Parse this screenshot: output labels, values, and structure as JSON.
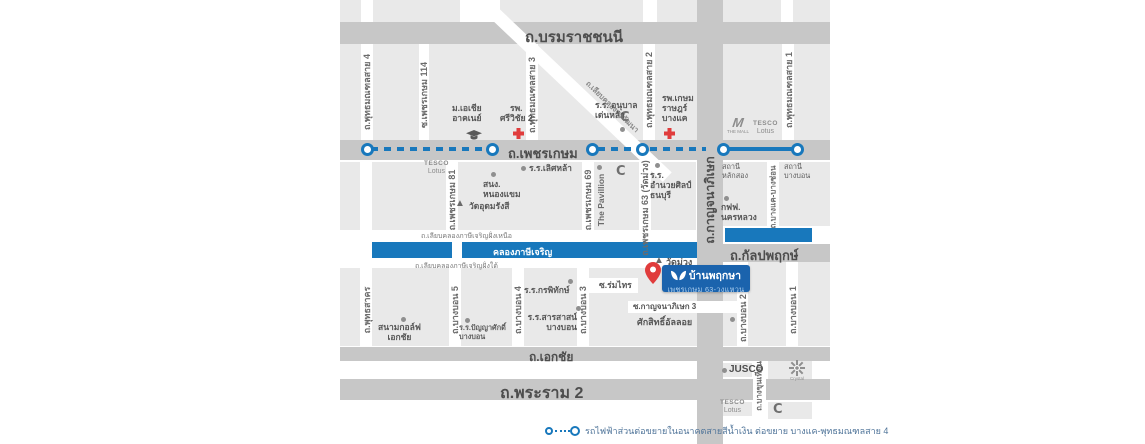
{
  "colors": {
    "canal_blue": "#1878bc",
    "mrt_blue": "#1878bc",
    "badge_blue": "#1b63ad",
    "marker_red": "#e03c3c",
    "block_gray": "#e9e9e9",
    "road_gray": "#c7c7c7"
  },
  "roads": {
    "borommaratchachonnani": "ถ.บรมราชชนนี",
    "phetkasem": "ถ.เพชรเกษม",
    "kanchanaphisek": "ถ.กาญจนาภิเษก",
    "kanlapaphruek": "ถ.กัลปพฤกษ์",
    "ekkachai": "ถ.เอกชัย",
    "rama2": "ถ.พระราม 2",
    "phutthamonthon4": "ถ.พุทธมณฑลสาย 4",
    "phetkasem114": "ซ.เพชรเกษม 114",
    "phutthamonthon3": "ถ.พุทธมณฑลสาย 3",
    "phutthamonthon2": "ถ.พุทธมณฑลสาย 2",
    "phutthamonthon1": "ถ.พุทธมณฑลสาย 1",
    "phetkasem81": "ถ.เพชรเกษม 81",
    "phetkasem69": "ถ.เพชรเกษม 69",
    "phetkasem63": "ถ.เพชรเกษม 63 (วัดม่วง)",
    "bangkhae_bangchon": "ถ.บางแค-บางช่อน",
    "phutthasakhon": "ถ.พุทธสาคร",
    "bangbon5": "ถ.บางบอน 5",
    "bangbon4": "ถ.บางบอน 4",
    "bangbon3": "ถ.บางบอน 3",
    "bangbon2": "ถ.บางบอน 2",
    "bangbon1": "ถ.บางบอน 1",
    "bangkhuntian": "ถ.บางขุนเทียน",
    "liapkhlong_thawiwatthana": "ถ.เลียบคลองทวีวัฒนา",
    "soi_romsai": "ซ.ร่มไทร",
    "soi_kanchanaphisek3": "ซ.กาญจนาภิเษก 3"
  },
  "canal": {
    "name": "คลองภาษีเจริญ",
    "north_bank_road": "ถ.เลียบคลองภาษีเจริญฝั่งเหนือ",
    "south_bank_road": "ถ.เลียบคลองภาษีเจริญฝั่งใต้"
  },
  "pois": {
    "asia_university": {
      "lines": [
        "ม.เอเชีย",
        "อาคเนย์"
      ]
    },
    "srivichai2_hospital": {
      "lines": [
        "รพ.",
        "ศรีวิชัย 2"
      ]
    },
    "denla_kindergarten": {
      "lines": [
        "ร.ร. อนุบาล",
        "เด่นหล้า"
      ]
    },
    "kasemrad_bangkhae_hospital": {
      "lines": [
        "รพ.เกษม",
        "ราษฎร์",
        "บางแค"
      ]
    },
    "lertlah_school": {
      "lines": [
        "ร.ร.เลิศหล้า"
      ]
    },
    "nongkhaem_office": {
      "lines": [
        "สนง.",
        "หนองแขม"
      ]
    },
    "wat_udomrangsi": {
      "lines": [
        "วัดอุดมรังสี"
      ]
    },
    "the_pavillion": {
      "lines": [
        "The Pavillion"
      ]
    },
    "amnuaysilpa_school": {
      "lines": [
        "ร.ร.",
        "อำนวยศิลป์",
        "ธนบุรี"
      ]
    },
    "lak_song_station": {
      "lines": [
        "สถานี",
        "หลักสอง"
      ]
    },
    "bang_bon_station": {
      "lines": [
        "สถานี",
        "บางบอน"
      ]
    },
    "mea_office": {
      "lines": [
        "กฟฟ.",
        "นครหลวง"
      ]
    },
    "wat_muang": {
      "lines": [
        "วัดม่วง"
      ]
    },
    "saksit_alloy": {
      "lines": [
        "ศักสิทธิ์อัลลอย"
      ]
    },
    "ekachai_golf": {
      "lines": [
        "สนามกอล์ฟ",
        "เอกชัย"
      ]
    },
    "panyasak_school": {
      "lines": [
        "ร.ร.ปัญญาศักดิ์",
        "บางบอน"
      ]
    },
    "kornpitack_school": {
      "lines": [
        "ร.ร.กรพิทักษ์"
      ]
    },
    "sarasas_bangbon_school": {
      "lines": [
        "ร.ร.สารสาสน์",
        "บางบอน"
      ]
    }
  },
  "brands": {
    "tesco": "TESCO",
    "lotus": "Lotus",
    "the_mall_m": "M",
    "the_mall": "THE MALL",
    "big_c": "C",
    "jusco": "JUSCO",
    "crystal": "Crystal"
  },
  "project": {
    "name": "บ้านพฤกษา",
    "subtitle": "เพชรเกษม 63-วงแหวน"
  },
  "legend": {
    "text": "รถไฟฟ้าส่วนต่อขยายในอนาคตสายสีน้ำเงิน ต่อขยาย บางแค-พุทธมณฑลสาย 4"
  }
}
